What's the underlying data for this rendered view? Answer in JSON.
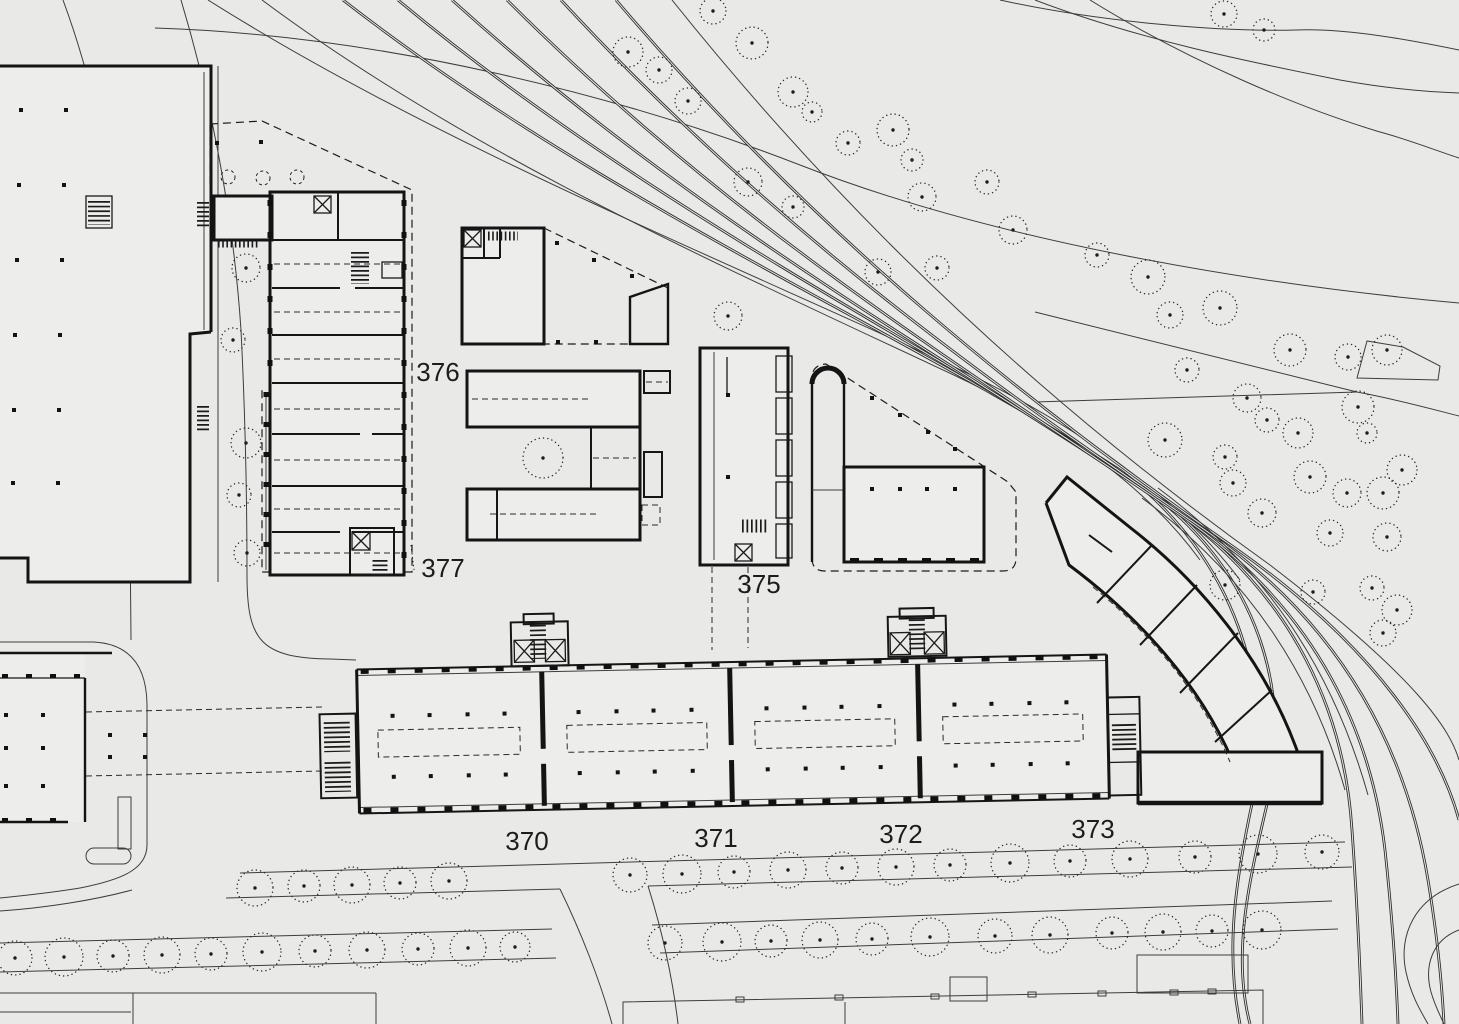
{
  "meta": {
    "drawing_type": "architectural site plan",
    "view": "top-down",
    "units": "none-visible"
  },
  "palette": {
    "background": "#e9e9e8",
    "ink": "#141414",
    "ink_soft": "#3d3d3d",
    "building_fill": "#ededec",
    "label_color": "#1c1c1c"
  },
  "labels": {
    "building_numbers": [
      {
        "text": "376",
        "x": 438,
        "y": 381
      },
      {
        "text": "377",
        "x": 443,
        "y": 577
      },
      {
        "text": "375",
        "x": 759,
        "y": 593
      },
      {
        "text": "370",
        "x": 527,
        "y": 850
      },
      {
        "text": "371",
        "x": 716,
        "y": 847
      },
      {
        "text": "372",
        "x": 901,
        "y": 843
      },
      {
        "text": "373",
        "x": 1093,
        "y": 838
      }
    ]
  },
  "trees": {
    "style": "dotted-circle-with-center-dot",
    "scattered": [
      [
        628,
        52,
        15
      ],
      [
        659,
        70,
        13
      ],
      [
        688,
        101,
        13
      ],
      [
        713,
        11,
        13
      ],
      [
        752,
        43,
        16
      ],
      [
        793,
        92,
        15
      ],
      [
        812,
        112,
        10
      ],
      [
        848,
        143,
        12
      ],
      [
        893,
        130,
        16
      ],
      [
        912,
        160,
        11
      ],
      [
        922,
        197,
        14
      ],
      [
        987,
        182,
        12
      ],
      [
        1013,
        230,
        14
      ],
      [
        937,
        268,
        12
      ],
      [
        878,
        272,
        13
      ],
      [
        748,
        182,
        14
      ],
      [
        793,
        207,
        11
      ],
      [
        1097,
        255,
        12
      ],
      [
        1148,
        277,
        17
      ],
      [
        1224,
        14,
        13
      ],
      [
        1264,
        30,
        11
      ],
      [
        1170,
        315,
        13
      ],
      [
        1220,
        308,
        17
      ],
      [
        1290,
        350,
        16
      ],
      [
        1348,
        357,
        13
      ],
      [
        1387,
        350,
        15
      ],
      [
        1187,
        370,
        12
      ],
      [
        1247,
        398,
        14
      ],
      [
        1267,
        420,
        12
      ],
      [
        1298,
        433,
        15
      ],
      [
        1358,
        407,
        16
      ],
      [
        1367,
        433,
        10
      ],
      [
        1165,
        440,
        17
      ],
      [
        1225,
        457,
        12
      ],
      [
        1233,
        483,
        13
      ],
      [
        1310,
        477,
        16
      ],
      [
        1347,
        493,
        14
      ],
      [
        1383,
        493,
        16
      ],
      [
        1262,
        513,
        14
      ],
      [
        1330,
        533,
        13
      ],
      [
        1387,
        537,
        14
      ],
      [
        1402,
        470,
        15
      ],
      [
        1225,
        585,
        15
      ],
      [
        1313,
        592,
        12
      ],
      [
        1372,
        588,
        12
      ],
      [
        1397,
        610,
        15
      ],
      [
        1383,
        633,
        13
      ],
      [
        246,
        268,
        14
      ],
      [
        233,
        340,
        12
      ],
      [
        246,
        443,
        15
      ],
      [
        239,
        495,
        12
      ],
      [
        247,
        553,
        13
      ],
      [
        543,
        458,
        20
      ],
      [
        728,
        316,
        14
      ]
    ],
    "avenue_upper": [
      [
        255,
        888,
        18
      ],
      [
        304,
        886,
        16
      ],
      [
        352,
        885,
        18
      ],
      [
        400,
        883,
        16
      ],
      [
        449,
        881,
        18
      ],
      [
        630,
        875,
        17
      ],
      [
        682,
        874,
        19
      ],
      [
        734,
        872,
        16
      ],
      [
        788,
        870,
        18
      ],
      [
        842,
        868,
        16
      ],
      [
        896,
        867,
        18
      ],
      [
        950,
        865,
        16
      ],
      [
        1010,
        863,
        19
      ],
      [
        1070,
        861,
        16
      ],
      [
        1130,
        859,
        18
      ],
      [
        1195,
        857,
        16
      ],
      [
        1258,
        854,
        19
      ],
      [
        1322,
        852,
        17
      ]
    ],
    "avenue_lower": [
      [
        15,
        958,
        17
      ],
      [
        64,
        957,
        19
      ],
      [
        113,
        956,
        16
      ],
      [
        162,
        955,
        18
      ],
      [
        211,
        954,
        16
      ],
      [
        262,
        952,
        19
      ],
      [
        315,
        951,
        16
      ],
      [
        367,
        950,
        18
      ],
      [
        418,
        949,
        16
      ],
      [
        468,
        948,
        18
      ],
      [
        515,
        947,
        15
      ],
      [
        665,
        943,
        17
      ],
      [
        722,
        942,
        19
      ],
      [
        771,
        941,
        16
      ],
      [
        820,
        940,
        18
      ],
      [
        872,
        939,
        16
      ],
      [
        930,
        937,
        19
      ],
      [
        995,
        936,
        17
      ],
      [
        1050,
        935,
        18
      ],
      [
        1112,
        933,
        16
      ],
      [
        1163,
        932,
        18
      ],
      [
        1212,
        931,
        16
      ],
      [
        1262,
        930,
        19
      ]
    ]
  },
  "dots": {
    "northwest_building": [
      [
        21,
        110
      ],
      [
        66,
        110
      ],
      [
        19,
        185
      ],
      [
        64,
        185
      ],
      [
        17,
        260
      ],
      [
        62,
        260
      ],
      [
        15,
        335
      ],
      [
        60,
        335
      ],
      [
        14,
        410
      ],
      [
        59,
        410
      ],
      [
        13,
        483
      ],
      [
        58,
        483
      ]
    ],
    "west_building": [
      [
        6,
        715
      ],
      [
        43,
        715
      ],
      [
        6,
        748
      ],
      [
        43,
        748
      ],
      [
        6,
        786
      ],
      [
        43,
        786
      ]
    ],
    "forecourt": [
      [
        110,
        735
      ],
      [
        145,
        735
      ],
      [
        110,
        757
      ],
      [
        145,
        757
      ]
    ],
    "north_terrace": [
      [
        217,
        143
      ],
      [
        261,
        142
      ]
    ],
    "north_small_diag": [
      [
        557,
        243
      ],
      [
        594,
        260
      ],
      [
        632,
        276
      ],
      [
        558,
        342
      ],
      [
        596,
        342
      ]
    ],
    "building_375": [
      [
        728,
        395
      ],
      [
        728,
        477
      ]
    ],
    "annex_diagonal": [
      [
        872,
        398
      ],
      [
        900,
        415
      ],
      [
        928,
        432
      ],
      [
        955,
        449
      ]
    ],
    "annex_wing": [
      [
        872,
        489
      ],
      [
        900,
        489
      ],
      [
        927,
        489
      ],
      [
        955,
        489
      ]
    ],
    "long_building_bays": [
      [
        393,
        709
      ],
      [
        430,
        709
      ],
      [
        468,
        709
      ],
      [
        505,
        709
      ],
      [
        393,
        770
      ],
      [
        430,
        770
      ],
      [
        468,
        770
      ],
      [
        505,
        770
      ],
      [
        579,
        709
      ],
      [
        617,
        709
      ],
      [
        654,
        709
      ],
      [
        692,
        709
      ],
      [
        579,
        770
      ],
      [
        617,
        770
      ],
      [
        654,
        770
      ],
      [
        692,
        770
      ],
      [
        767,
        709
      ],
      [
        805,
        709
      ],
      [
        842,
        709
      ],
      [
        880,
        709
      ],
      [
        767,
        770
      ],
      [
        805,
        770
      ],
      [
        842,
        770
      ],
      [
        880,
        770
      ],
      [
        955,
        709
      ],
      [
        992,
        709
      ],
      [
        1030,
        709
      ],
      [
        1067,
        709
      ],
      [
        955,
        770
      ],
      [
        992,
        770
      ],
      [
        1030,
        770
      ],
      [
        1067,
        770
      ]
    ]
  }
}
